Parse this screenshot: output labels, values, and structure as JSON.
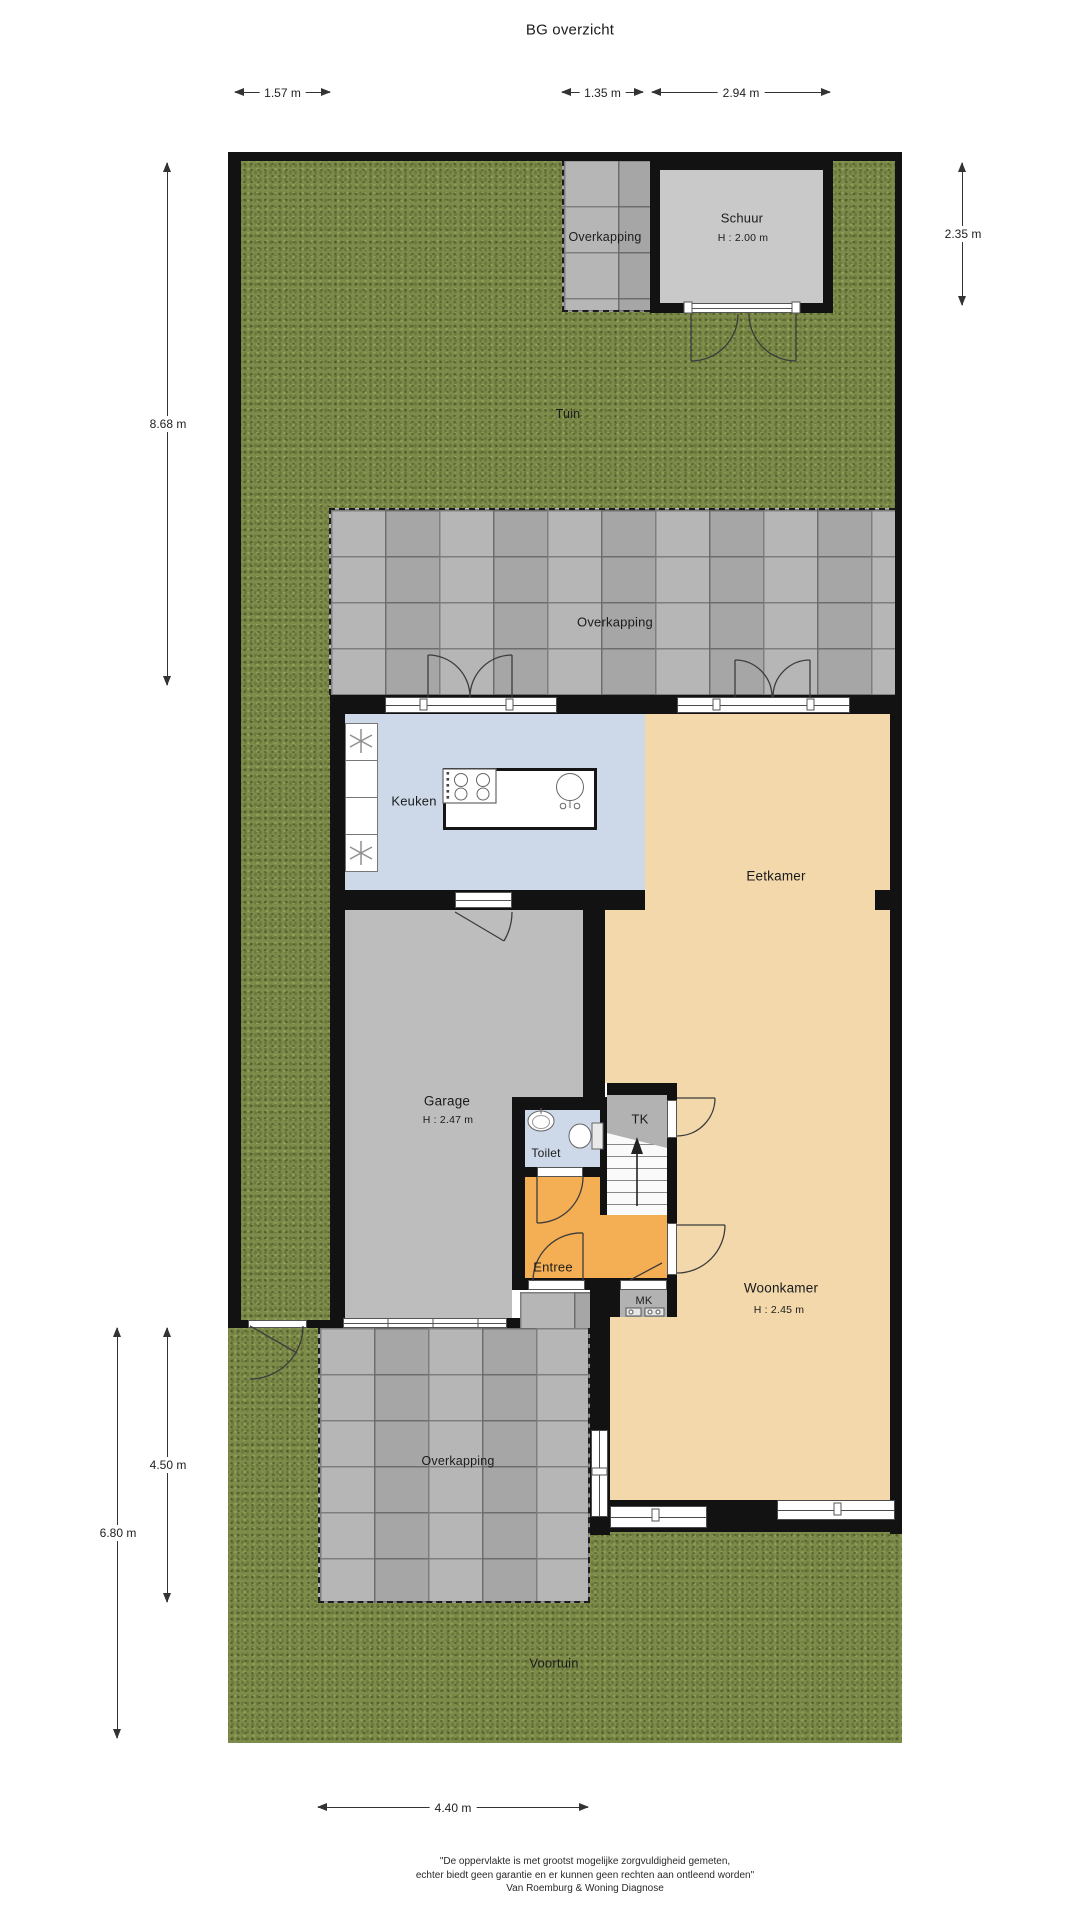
{
  "title": "BG overzicht",
  "outdoor": {
    "tuin": "Tuin",
    "voortuin": "Voortuin",
    "overkapping_top": "Overkapping",
    "overkapping_mid": "Overkapping",
    "overkapping_front": "Overkapping"
  },
  "rooms": {
    "schuur": {
      "name": "Schuur",
      "height": "H : 2.00 m"
    },
    "keuken": {
      "name": "Keuken"
    },
    "eetkamer": {
      "name": "Eetkamer"
    },
    "garage": {
      "name": "Garage",
      "height": "H : 2.47 m"
    },
    "toilet": {
      "name": "Toilet"
    },
    "tk": {
      "name": "TK"
    },
    "entree": {
      "name": "Entree"
    },
    "mk": {
      "name": "MK"
    },
    "woonkamer": {
      "name": "Woonkamer",
      "height": "H : 2.45 m"
    }
  },
  "dimensions": {
    "top_left": "1.57 m",
    "top_mid": "1.35 m",
    "top_right": "2.94 m",
    "right": "2.35 m",
    "left_upper": "8.68 m",
    "left_lower_inner": "4.50 m",
    "left_lower_outer": "6.80 m",
    "bottom": "4.40 m"
  },
  "footer": {
    "line1": "\"De oppervlakte is met grootst mogelijke zorgvuldigheid gemeten,",
    "line2": "echter biedt geen garantie en er kunnen geen rechten aan ontleend worden\"",
    "line3": "Van Roemburg & Woning Diagnose"
  },
  "colors": {
    "grass": "#7e8c4b",
    "paving": "#b0b0b0",
    "wall": "#121212",
    "tan": "#f2d8ab",
    "blue": "#cdd9e9",
    "orange": "#f4ae54",
    "garage": "#bdbdbd",
    "shed": "#c9c9c9",
    "closet": "#b2b2b2"
  }
}
